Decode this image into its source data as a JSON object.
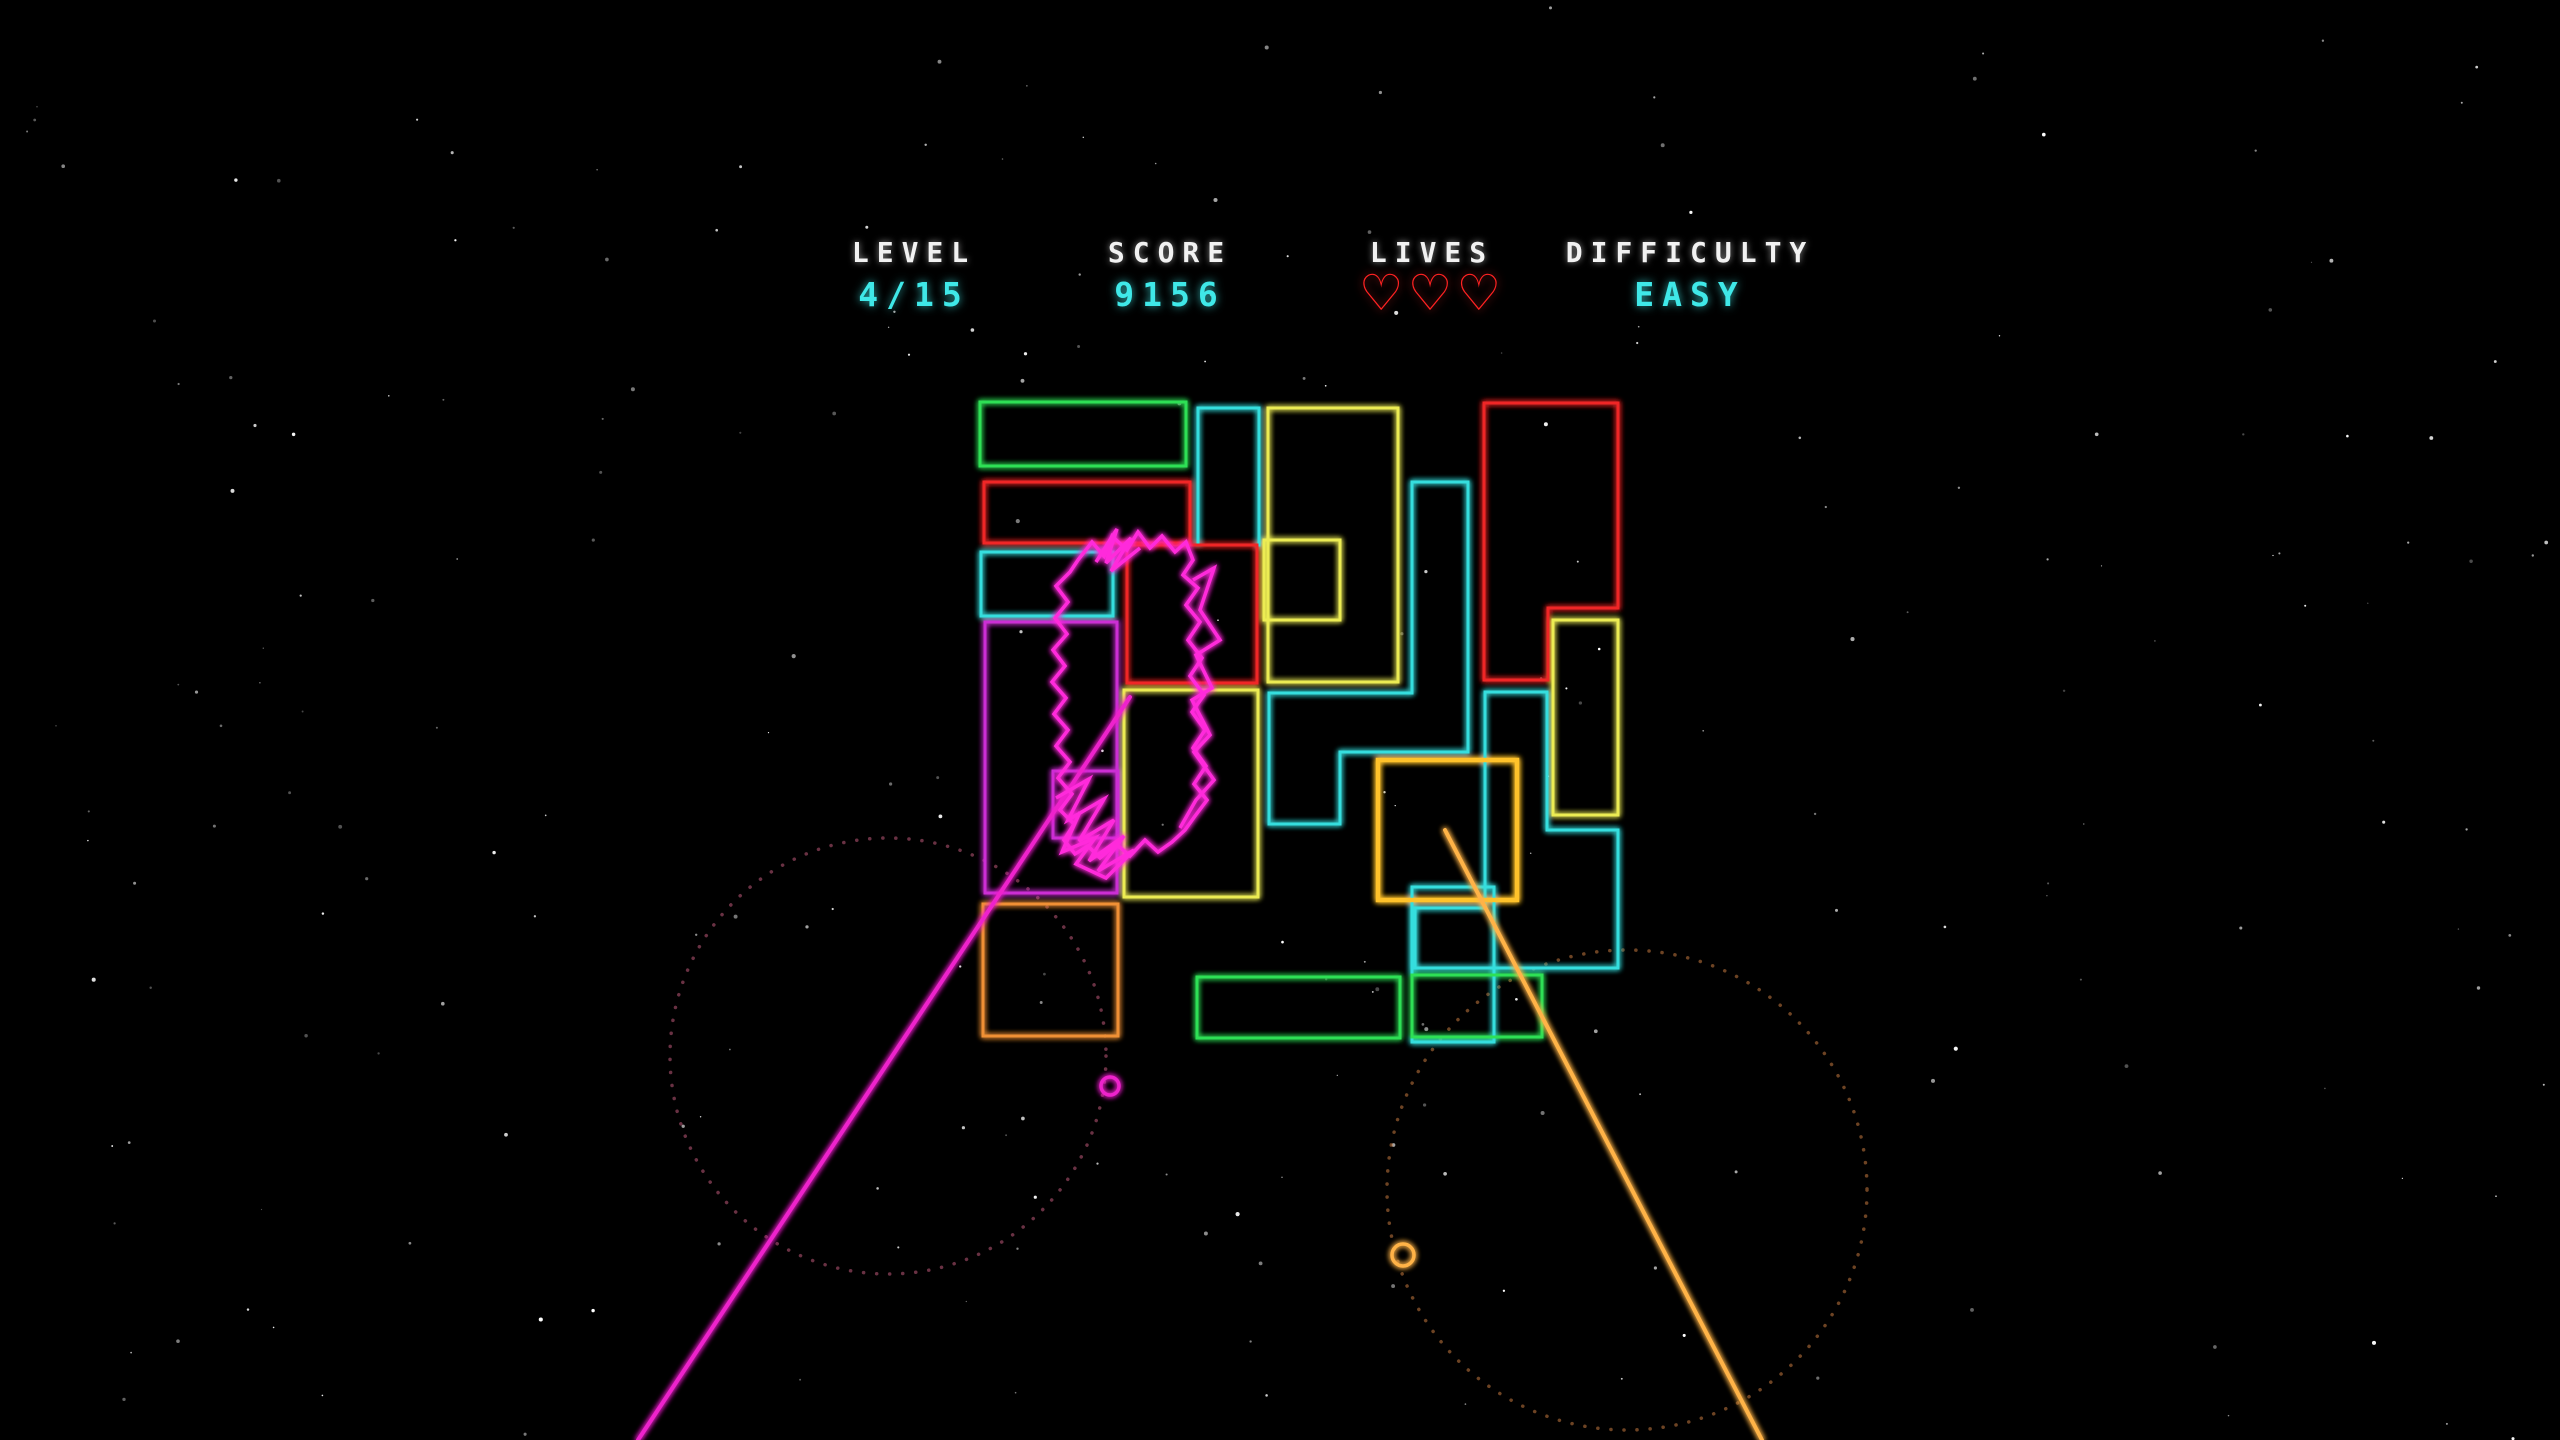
{
  "hud": {
    "level": {
      "label": "LEVEL",
      "value": "4/15",
      "center_x": 914
    },
    "score": {
      "label": "SCORE",
      "value": "9156",
      "center_x": 1170
    },
    "lives": {
      "label": "LIVES",
      "count": 3,
      "heart_symbol": "♡",
      "center_x": 1432
    },
    "difficulty": {
      "label": "DIFFICULTY",
      "value": "EASY",
      "center_x": 1690
    }
  },
  "colors": {
    "green": "#2fe055",
    "red": "#f02525",
    "cyan": "#35dede",
    "yellow": "#ecec52",
    "gold": "#ffc22a",
    "magenta": "#cc2fd4",
    "creature": "#ff2bdb",
    "orange": "#f09035",
    "beam_magenta": "#ee22cc",
    "beam_orange": "#ffb347",
    "dot_pink": "#c05a7a",
    "dot_orange": "#c77a3f",
    "star": "#ffffff"
  },
  "playfield": {
    "shapes": [
      {
        "name": "green-rect-top",
        "color": "green",
        "kind": "rect",
        "rect": [
          980,
          402,
          206,
          64
        ]
      },
      {
        "name": "cyan-rect-top",
        "color": "cyan",
        "kind": "rect",
        "rect": [
          1198,
          408,
          61,
          137
        ]
      },
      {
        "name": "yellow-big-rect",
        "color": "yellow",
        "kind": "rect",
        "rect": [
          1268,
          408,
          130,
          274
        ]
      },
      {
        "name": "yellow-notch-rect",
        "color": "yellow",
        "kind": "rect",
        "rect": [
          1264,
          540,
          76,
          80
        ]
      },
      {
        "name": "red-rect-row2",
        "color": "red",
        "kind": "rect",
        "rect": [
          984,
          482,
          206,
          61
        ]
      },
      {
        "name": "cyan-rect-left",
        "color": "cyan",
        "kind": "rect",
        "rect": [
          981,
          552,
          132,
          64
        ]
      },
      {
        "name": "red-rect-center",
        "color": "red",
        "kind": "rect",
        "rect": [
          1127,
          545,
          130,
          138
        ]
      },
      {
        "name": "magenta-rect-big",
        "color": "magenta",
        "kind": "rect",
        "rect": [
          985,
          622,
          132,
          271
        ]
      },
      {
        "name": "magenta-rect-inner",
        "color": "magenta",
        "kind": "rect",
        "rect": [
          1053,
          771,
          65,
          67
        ]
      },
      {
        "name": "yellow-rect-mid",
        "color": "yellow",
        "kind": "rect",
        "rect": [
          1124,
          690,
          134,
          207
        ]
      },
      {
        "name": "orange-rect",
        "color": "orange",
        "kind": "rect",
        "rect": [
          983,
          904,
          135,
          132
        ]
      },
      {
        "name": "red-l-piece",
        "color": "red",
        "kind": "poly",
        "points": [
          [
            1484,
            403
          ],
          [
            1618,
            403
          ],
          [
            1618,
            608
          ],
          [
            1548,
            608
          ],
          [
            1548,
            680
          ],
          [
            1484,
            680
          ]
        ]
      },
      {
        "name": "cyan-z-piece",
        "color": "cyan",
        "kind": "poly",
        "points": [
          [
            1412,
            482
          ],
          [
            1468,
            482
          ],
          [
            1468,
            752
          ],
          [
            1340,
            752
          ],
          [
            1340,
            824
          ],
          [
            1269,
            824
          ],
          [
            1269,
            693
          ],
          [
            1412,
            693
          ]
        ]
      },
      {
        "name": "cyan-s-piece",
        "color": "cyan",
        "kind": "poly",
        "points": [
          [
            1485,
            692
          ],
          [
            1547,
            692
          ],
          [
            1547,
            830
          ],
          [
            1618,
            830
          ],
          [
            1618,
            968
          ],
          [
            1415,
            968
          ],
          [
            1415,
            908
          ],
          [
            1485,
            908
          ]
        ]
      },
      {
        "name": "yellow-rect-right",
        "color": "yellow",
        "kind": "rect",
        "rect": [
          1553,
          620,
          65,
          195
        ]
      },
      {
        "name": "cyan-rect-bottom",
        "color": "cyan",
        "kind": "rect",
        "rect": [
          1412,
          887,
          82,
          155
        ]
      },
      {
        "name": "gold-square",
        "color": "gold",
        "kind": "rect",
        "rect": [
          1378,
          760,
          139,
          140
        ],
        "stroke": 4.5
      },
      {
        "name": "green-rect-bottom-a",
        "color": "green",
        "kind": "rect",
        "rect": [
          1197,
          977,
          203,
          61
        ]
      },
      {
        "name": "green-rect-bottom-b",
        "color": "green",
        "kind": "rect",
        "rect": [
          1412,
          975,
          130,
          62
        ]
      }
    ],
    "creature": {
      "color": "creature",
      "paths": [
        [
          [
            1078,
            560
          ],
          [
            1092,
            542
          ],
          [
            1104,
            556
          ],
          [
            1112,
            536
          ],
          [
            1127,
            550
          ],
          [
            1138,
            532
          ],
          [
            1150,
            548
          ],
          [
            1162,
            536
          ],
          [
            1175,
            552
          ],
          [
            1186,
            542
          ],
          [
            1193,
            560
          ],
          [
            1183,
            575
          ],
          [
            1198,
            588
          ],
          [
            1186,
            605
          ],
          [
            1200,
            622
          ],
          [
            1188,
            640
          ],
          [
            1202,
            658
          ],
          [
            1190,
            676
          ],
          [
            1204,
            695
          ],
          [
            1192,
            712
          ],
          [
            1205,
            730
          ],
          [
            1193,
            748
          ],
          [
            1206,
            766
          ],
          [
            1194,
            784
          ],
          [
            1207,
            800
          ],
          [
            1195,
            816
          ],
          [
            1185,
            830
          ],
          [
            1172,
            842
          ],
          [
            1158,
            852
          ],
          [
            1145,
            840
          ],
          [
            1130,
            856
          ],
          [
            1116,
            844
          ],
          [
            1100,
            858
          ],
          [
            1088,
            846
          ],
          [
            1075,
            854
          ],
          [
            1064,
            840
          ],
          [
            1074,
            824
          ],
          [
            1060,
            810
          ],
          [
            1072,
            794
          ],
          [
            1058,
            778
          ],
          [
            1070,
            762
          ],
          [
            1056,
            746
          ],
          [
            1068,
            730
          ],
          [
            1054,
            714
          ],
          [
            1066,
            698
          ],
          [
            1052,
            682
          ],
          [
            1065,
            666
          ],
          [
            1053,
            650
          ],
          [
            1067,
            634
          ],
          [
            1055,
            618
          ],
          [
            1068,
            602
          ],
          [
            1056,
            586
          ],
          [
            1070,
            572
          ],
          [
            1078,
            560
          ]
        ],
        [
          [
            1056,
            798
          ],
          [
            1089,
            779
          ],
          [
            1068,
            820
          ],
          [
            1104,
            799
          ],
          [
            1079,
            841
          ],
          [
            1114,
            820
          ],
          [
            1089,
            861
          ],
          [
            1124,
            836
          ],
          [
            1098,
            871
          ],
          [
            1134,
            850
          ],
          [
            1106,
            878
          ],
          [
            1076,
            864
          ],
          [
            1095,
            838
          ],
          [
            1062,
            852
          ],
          [
            1080,
            812
          ]
        ],
        [
          [
            1096,
            562
          ],
          [
            1117,
            529
          ],
          [
            1106,
            563
          ],
          [
            1131,
            538
          ],
          [
            1111,
            571
          ],
          [
            1140,
            548
          ]
        ],
        [
          [
            1193,
            580
          ],
          [
            1214,
            568
          ],
          [
            1200,
            610
          ],
          [
            1220,
            640
          ],
          [
            1196,
            655
          ],
          [
            1212,
            688
          ],
          [
            1192,
            700
          ],
          [
            1210,
            735
          ],
          [
            1194,
            752
          ],
          [
            1214,
            780
          ],
          [
            1196,
            800
          ],
          [
            1180,
            828
          ]
        ]
      ]
    },
    "beams": [
      {
        "name": "magenta-laser-beam",
        "color": "beam_magenta",
        "from": [
          1130,
          697
        ],
        "to": [
          638,
          1440
        ]
      },
      {
        "name": "orange-laser-beam",
        "color": "beam_orange",
        "from": [
          1445,
          830
        ],
        "to": [
          1762,
          1440
        ]
      }
    ],
    "bullets": [
      {
        "name": "magenta-ring-bullet",
        "color": "beam_magenta",
        "cx": 1110,
        "cy": 1086,
        "r": 9
      },
      {
        "name": "orange-ring-bullet",
        "color": "beam_orange",
        "cx": 1403,
        "cy": 1255,
        "r": 11
      }
    ],
    "dotted_circles": [
      {
        "name": "pink-dotted-circle",
        "color": "dot_pink",
        "cx": 888,
        "cy": 1056,
        "r": 218
      },
      {
        "name": "orange-dotted-circle",
        "color": "dot_orange",
        "cx": 1627,
        "cy": 1190,
        "r": 240
      }
    ],
    "stars": {
      "count": 240,
      "seed": 1337
    }
  }
}
